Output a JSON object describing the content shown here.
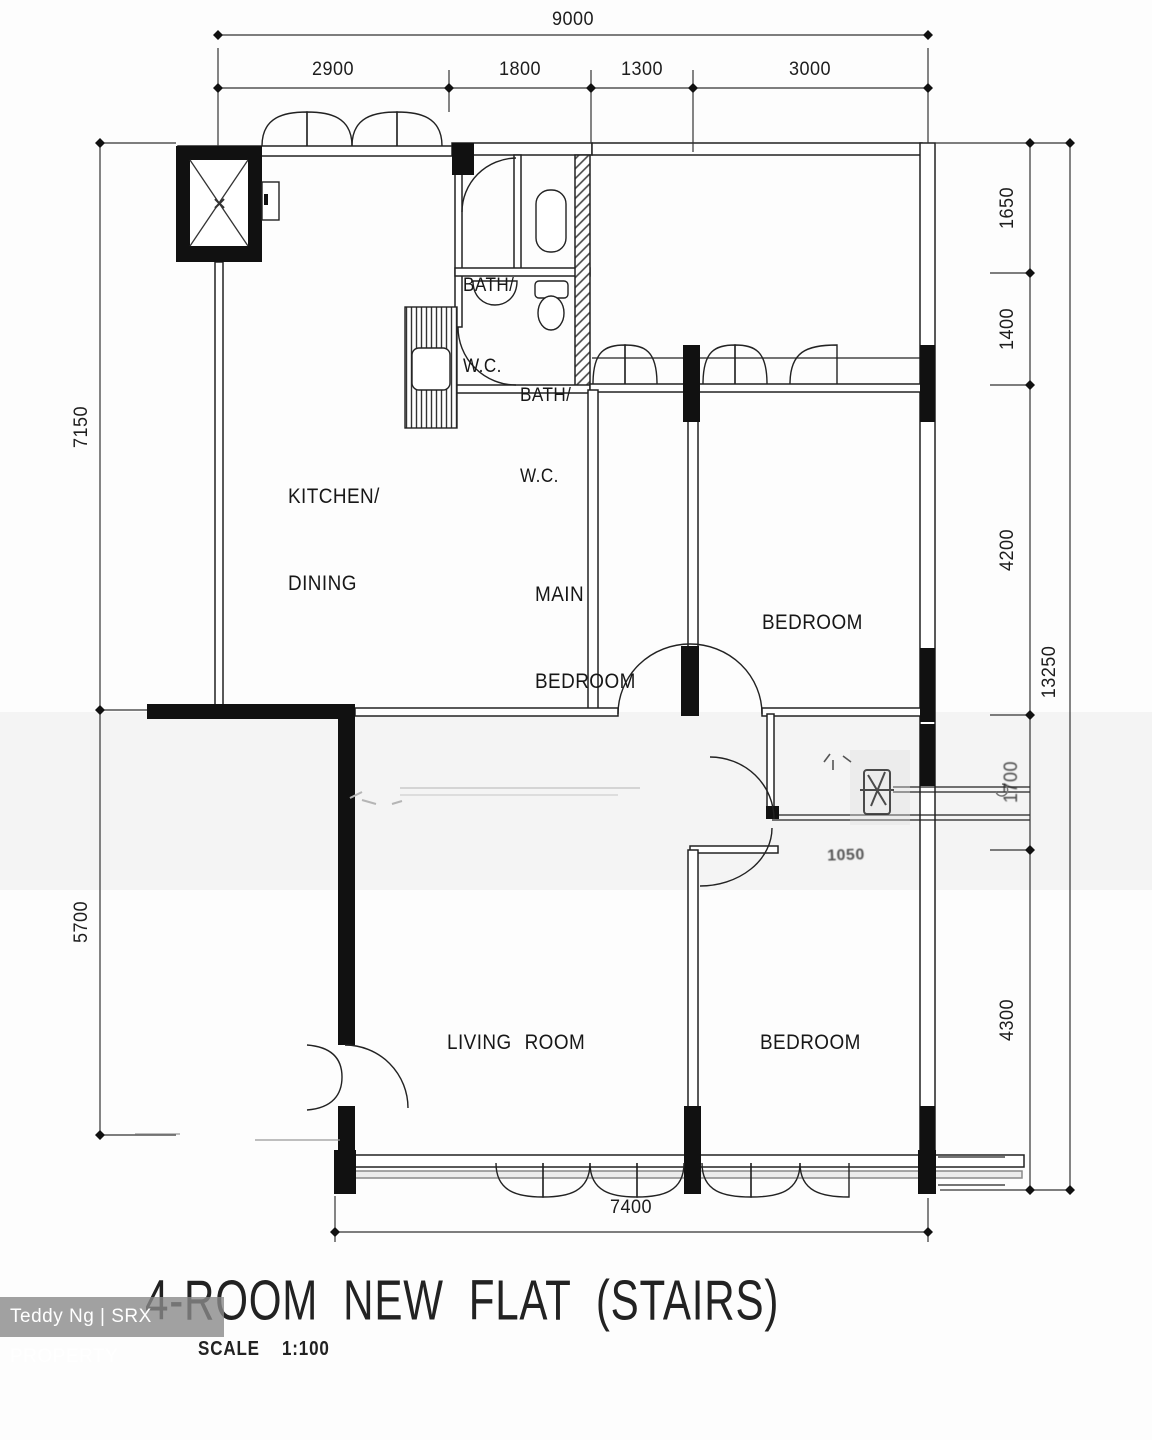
{
  "title": {
    "name": "4-ROOM NEW FLAT (STAIRS)",
    "scale_label": "SCALE",
    "scale_value": "1:100"
  },
  "watermark": {
    "text": "Teddy Ng | SRX PROPERTY"
  },
  "rooms": {
    "kitchen_line1": "KITCHEN/",
    "kitchen_line2": "DINING",
    "bath1_line1": "BATH/",
    "bath1_line2": "W.C.",
    "bath2_line1": "BATH/",
    "bath2_line2": "W.C.",
    "main_bedroom_line1": "MAIN",
    "main_bedroom_line2": "BEDROOM",
    "bedroom_top": "BEDROOM",
    "living_room": "LIVING ROOM",
    "bedroom_bottom": "BEDROOM"
  },
  "dimensions": {
    "top_total": "9000",
    "top_segments": [
      "2900",
      "1800",
      "1300",
      "3000"
    ],
    "left_upper": "7150",
    "left_lower": "5700",
    "right_segments": [
      "1650",
      "1400",
      "4200",
      "1700",
      "4300"
    ],
    "right_total": "13250",
    "bottom": "7400",
    "corridor": "1050"
  }
}
